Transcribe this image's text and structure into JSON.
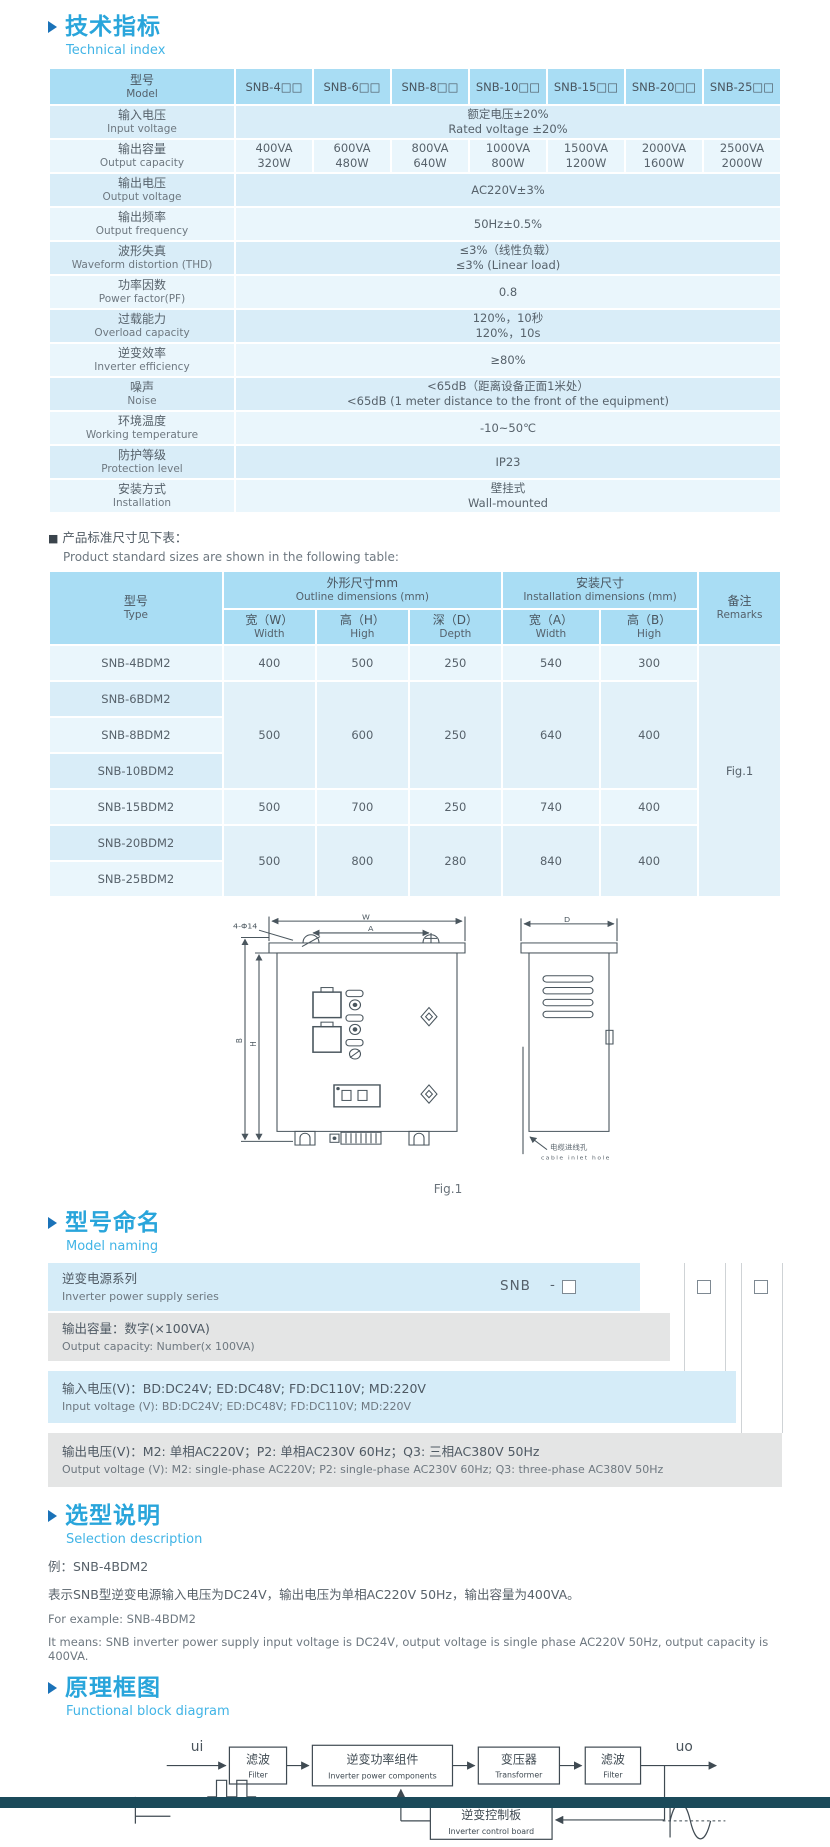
{
  "colors": {
    "accent_blue": "#29a5db",
    "accent_light": "#41b4e6",
    "arrow_blue": "#1a72b8",
    "table_header_bg": "#a9ddf4",
    "row_dark": "#d9edf8",
    "row_light": "#eaf6fc",
    "naming_blue": "#d5ecf8",
    "naming_gray": "#e4e5e5",
    "footer_bar": "#1b4a5a"
  },
  "sections": {
    "technical": {
      "title_zh": "技术指标",
      "title_en": "Technical index"
    },
    "note": {
      "bullet": "■",
      "zh": "产品标准尺寸见下表：",
      "en": "Product standard sizes are shown in the following table:"
    },
    "naming": {
      "title_zh": "型号命名",
      "title_en": "Model naming"
    },
    "selection": {
      "title_zh": "选型说明",
      "title_en": "Selection description"
    },
    "diagram": {
      "title_zh": "原理框图",
      "title_en": "Functional block diagram"
    }
  },
  "spec_table": {
    "model_label_zh": "型号",
    "model_label_en": "Model",
    "models": [
      "SNB-4□□",
      "SNB-6□□",
      "SNB-8□□",
      "SNB-10□□",
      "SNB-15□□",
      "SNB-20□□",
      "SNB-25□□"
    ],
    "rows": {
      "input_voltage": {
        "zh": "输入电压",
        "en": "Input voltage",
        "v1": "额定电压±20%",
        "v2": "Rated voltage ±20%"
      },
      "output_capacity": {
        "zh": "输出容量",
        "en": "Output capacity",
        "va": [
          "400VA",
          "600VA",
          "800VA",
          "1000VA",
          "1500VA",
          "2000VA",
          "2500VA"
        ],
        "w": [
          "320W",
          "480W",
          "640W",
          "800W",
          "1200W",
          "1600W",
          "2000W"
        ]
      },
      "output_voltage": {
        "zh": "输出电压",
        "en": "Output voltage",
        "v1": "AC220V±3%"
      },
      "output_frequency": {
        "zh": "输出频率",
        "en": "Output frequency",
        "v1": "50Hz±0.5%"
      },
      "thd": {
        "zh": "波形失真",
        "en": "Waveform distortion (THD)",
        "v1": "≤3%（线性负载）",
        "v2": "≤3% (Linear load)"
      },
      "pf": {
        "zh": "功率因数",
        "en": "Power factor(PF)",
        "v1": "0.8"
      },
      "overload": {
        "zh": "过载能力",
        "en": "Overload capacity",
        "v1": "120%，10秒",
        "v2": "120%，10s"
      },
      "efficiency": {
        "zh": "逆变效率",
        "en": "Inverter efficiency",
        "v1": "≥80%"
      },
      "noise": {
        "zh": "噪声",
        "en": "Noise",
        "v1": "<65dB（距离设备正面1米处）",
        "v2": "<65dB (1 meter distance to the front of the equipment)"
      },
      "temperature": {
        "zh": "环境温度",
        "en": "Working temperature",
        "v1": "-10~50℃"
      },
      "protection": {
        "zh": "防护等级",
        "en": "Protection level",
        "v1": "IP23"
      },
      "installation": {
        "zh": "安装方式",
        "en": "Installation",
        "v1": "壁挂式",
        "v2": "Wall-mounted"
      }
    }
  },
  "dim_table": {
    "type_zh": "型号",
    "type_en": "Type",
    "outline_zh": "外形尺寸mm",
    "outline_en": "Outline dimensions (mm)",
    "install_zh": "安装尺寸",
    "install_en": "Installation dimensions (mm)",
    "remarks_zh": "备注",
    "remarks_en": "Remarks",
    "w_zh": "宽（W）",
    "w_en": "Width",
    "h_zh": "高（H）",
    "h_en": "High",
    "d_zh": "深（D）",
    "d_en": "Depth",
    "a_zh": "宽（A）",
    "a_en": "Width",
    "b_zh": "高（B）",
    "b_en": "High",
    "remark_value": "Fig.1",
    "rows": [
      {
        "type": "SNB-4BDM2",
        "w": "400",
        "h": "500",
        "d": "250",
        "a": "540",
        "b": "300"
      },
      {
        "type": "SNB-6BDM2",
        "w": "500",
        "h": "600",
        "d": "250",
        "a": "640",
        "b": "400"
      },
      {
        "type": "SNB-8BDM2"
      },
      {
        "type": "SNB-10BDM2"
      },
      {
        "type": "SNB-15BDM2",
        "w": "500",
        "h": "700",
        "d": "250",
        "a": "740",
        "b": "400"
      },
      {
        "type": "SNB-20BDM2",
        "w": "500",
        "h": "800",
        "d": "280",
        "a": "840",
        "b": "400"
      },
      {
        "type": "SNB-25BDM2"
      }
    ]
  },
  "figure": {
    "caption": "Fig.1",
    "dim_w": "W",
    "dim_a": "A",
    "dim_d": "D",
    "dim_h": "H",
    "dim_b": "B",
    "holes_label": "4-Φ14",
    "cable_zh": "电缆进线孔",
    "cable_en": "cable inlet hole"
  },
  "naming": {
    "code_prefix": "SNB",
    "code_dash": "-",
    "rows": [
      {
        "zh": "逆变电源系列",
        "en": "Inverter power supply series"
      },
      {
        "zh": "输出容量：数字(×100VA)",
        "en": "Output capacity: Number(x 100VA)"
      },
      {
        "zh": "输入电压(V)：BD:DC24V; ED:DC48V; FD:DC110V; MD:220V",
        "en": "Input voltage (V): BD:DC24V; ED:DC48V; FD:DC110V; MD:220V"
      },
      {
        "zh": "输出电压(V)：M2: 单相AC220V；P2: 单相AC230V 60Hz；Q3: 三相AC380V 50Hz",
        "en": "Output voltage (V): M2: single-phase AC220V; P2: single-phase AC230V 60Hz; Q3: three-phase AC380V 50Hz"
      }
    ]
  },
  "selection": {
    "example_zh": "例：SNB-4BDM2",
    "desc_zh": "表示SNB型逆变电源输入电压为DC24V，输出电压为单相AC220V 50Hz，输出容量为400VA。",
    "example_en": "For example: SNB-4BDM2",
    "desc_en": "It means: SNB inverter power supply input voltage is DC24V, output voltage is single phase AC220V 50Hz, output capacity is 400VA."
  },
  "block_diagram": {
    "input_label": "ui",
    "output_label": "uo",
    "filter1_zh": "滤波",
    "filter1_en": "Filter",
    "inverter_zh": "逆变功率组件",
    "inverter_en": "Inverter power components",
    "transformer_zh": "变压器",
    "transformer_en": "Transformer",
    "filter2_zh": "滤波",
    "filter2_en": "Filter",
    "control_zh": "逆变控制板",
    "control_en": "Inverter control board"
  }
}
